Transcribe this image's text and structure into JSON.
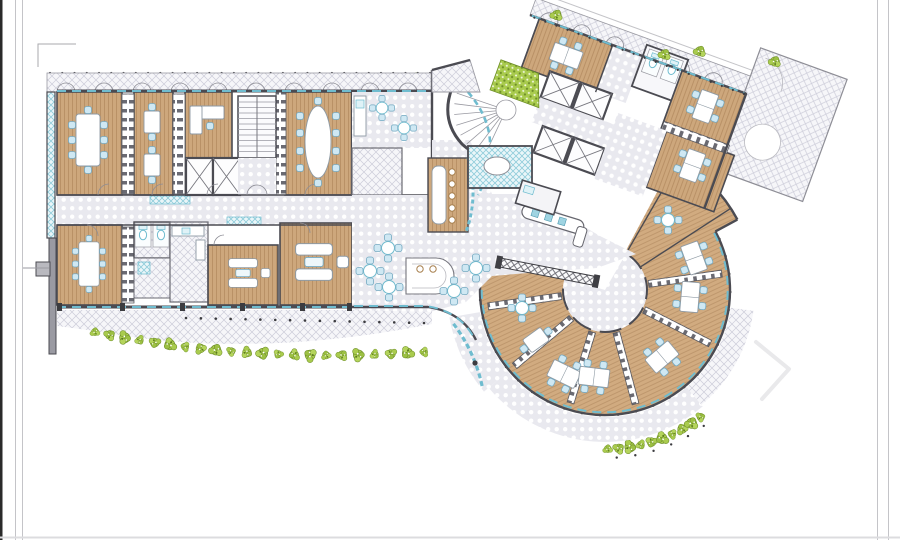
{
  "document": {
    "kind": "architectural-floor-plan",
    "description": "Office floor plan: left rectangular office wing, central cafe atrium with curved stair and elevator cores, rotated north-east office wing, and a fan-shaped open-plan office to the south-east, with landscaped hedges along the facades",
    "visible_text": ""
  },
  "colors": {
    "wood": "#cda77c",
    "woodLine": "#b48c61",
    "tileBg": "#e9e9ef",
    "tileDot": "#ffffff",
    "hatchBg": "#f6f6f9",
    "hatchLine": "#ccccd9",
    "teal": "#6fbccf",
    "tealPale": "#dff2f7",
    "wall": "#4b4b52",
    "wallMid": "#8e8e96",
    "chair": "#cfe8f3",
    "chairStroke": "#74a9c1",
    "green": "#a9cb4e",
    "greenDark": "#6d8d28",
    "furnStroke": "#8e9aa4",
    "post": "#3c3c40",
    "frame": "#c4c4c8",
    "watermark": "#e9e9eb"
  },
  "decor": {
    "furniture": [
      {
        "s": "conf8",
        "x": 88,
        "y": 140
      },
      {
        "s": "desk2",
        "x": 152,
        "y": 122
      },
      {
        "s": "desk2",
        "x": 152,
        "y": 165
      },
      {
        "s": "oval12",
        "x": 318,
        "y": 142
      },
      {
        "s": "conf8",
        "x": 89,
        "y": 264,
        "sc": 0.85
      },
      {
        "s": "sofaset",
        "x": 243,
        "y": 273,
        "sc": 0.9
      },
      {
        "s": "sofaset",
        "x": 314,
        "y": 262,
        "sc": 1.15
      },
      {
        "s": "round4",
        "x": 382,
        "y": 108,
        "sc": 0.9
      },
      {
        "s": "round4",
        "x": 404,
        "y": 128,
        "sc": 0.9
      },
      {
        "s": "round4",
        "x": 388,
        "y": 248
      },
      {
        "s": "round4",
        "x": 370,
        "y": 271
      },
      {
        "s": "round4",
        "x": 389,
        "y": 287
      },
      {
        "s": "round4",
        "x": 454,
        "y": 291
      },
      {
        "s": "round4",
        "x": 476,
        "y": 268
      },
      {
        "s": "stool",
        "x": 452,
        "y": 172
      },
      {
        "s": "stool",
        "x": 452,
        "y": 184
      },
      {
        "s": "stool",
        "x": 452,
        "y": 196
      },
      {
        "s": "stool",
        "x": 452,
        "y": 208
      },
      {
        "s": "stool",
        "x": 452,
        "y": 220
      },
      {
        "s": "stool",
        "x": 420,
        "y": 269
      },
      {
        "s": "stool",
        "x": 433,
        "y": 269
      },
      {
        "s": "round4",
        "x": 522,
        "y": 308
      },
      {
        "s": "desk2",
        "x": 536,
        "y": 340,
        "r": 54
      },
      {
        "s": "desk4",
        "x": 564,
        "y": 374,
        "r": 26
      },
      {
        "s": "desk4",
        "x": 594,
        "y": 377,
        "r": 7
      },
      {
        "s": "desk4",
        "x": 662,
        "y": 357,
        "r": -40
      },
      {
        "s": "desk4",
        "x": 690,
        "y": 297,
        "r": -85
      },
      {
        "s": "desk4",
        "x": 694,
        "y": 258,
        "r": -110
      },
      {
        "s": "round4",
        "x": 668,
        "y": 220
      },
      {
        "s": "desk4",
        "x": 48,
        "y": 26,
        "g": "wingDeco"
      },
      {
        "s": "desk4",
        "x": 196,
        "y": 26,
        "r": 90,
        "g": "wingDeco"
      },
      {
        "s": "desk4",
        "x": 204,
        "y": 86,
        "r": 90,
        "g": "wingDeco"
      }
    ],
    "bushes": [
      {
        "x": 56,
        "y": 80
      },
      {
        "x": 150,
        "y": 81
      },
      {
        "x": 243,
        "y": 82
      },
      {
        "x": 338,
        "y": 80
      },
      {
        "x": 416,
        "y": 78
      },
      {
        "x": 25,
        "y": -9,
        "g": "wingDeco"
      },
      {
        "x": 140,
        "y": -9,
        "g": "wingDeco"
      },
      {
        "x": 172,
        "y": -24,
        "g": "wingDeco"
      },
      {
        "x": 246,
        "y": -40,
        "g": "wingDeco"
      }
    ],
    "bush_paths": [
      {
        "kind": "quad",
        "p0": [
          95,
          332
        ],
        "c": [
          250,
          364
        ],
        "p1": [
          424,
          352
        ],
        "n": 22
      },
      {
        "kind": "arc",
        "c": [
          605,
          290
        ],
        "r": 141,
        "a0": 127,
        "a1": 93,
        "n": 7
      },
      {
        "kind": "arc",
        "c": [
          605,
          290
        ],
        "r": 159,
        "a0": 89,
        "a1": 53,
        "n": 10
      }
    ],
    "dot_rows": [
      {
        "kind": "line",
        "p0": [
          186,
          318
        ],
        "p1": [
          424,
          323
        ],
        "n": 17,
        "dr": 1.3
      },
      {
        "kind": "line",
        "p0": [
          50,
          73
        ],
        "p1": [
          430,
          73
        ],
        "n": 32,
        "dr": 1.1
      },
      {
        "kind": "arc",
        "c": [
          605,
          290
        ],
        "r": 125,
        "a0": -24,
        "a1": 192,
        "n": 27,
        "dr": 1.5
      },
      {
        "kind": "arc",
        "c": [
          605,
          290
        ],
        "r": 148,
        "a0": 124,
        "a1": 96,
        "n": 5,
        "dr": 1.2
      },
      {
        "kind": "arc",
        "c": [
          605,
          290
        ],
        "r": 168,
        "a0": 86,
        "a1": 54,
        "n": 6,
        "dr": 1.2
      },
      {
        "kind": "line",
        "p0": [
          5,
          1
        ],
        "p1": [
          228,
          1
        ],
        "n": 20,
        "dr": 1.1,
        "g": "wingDeco"
      }
    ],
    "watermark_chevron": "756,342 789,369 762,399"
  }
}
